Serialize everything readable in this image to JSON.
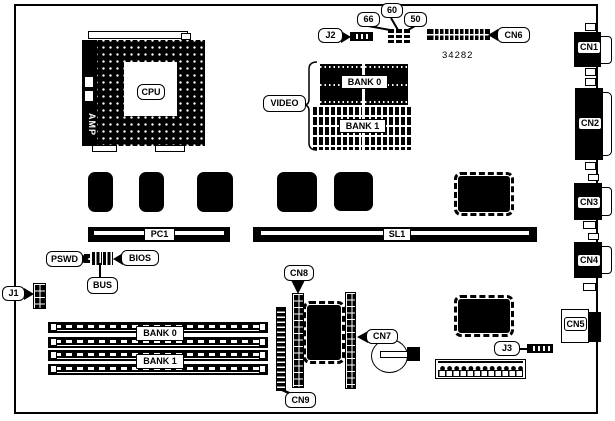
{
  "board": {
    "part_number": "34282",
    "cpu_label": "CPU",
    "cpu_socket_brand": "AMP",
    "video_label": "VIDEO",
    "video_bank0": "BANK 0",
    "video_bank1": "BANK 1",
    "simm_bank0": "BANK 0",
    "simm_bank1": "BANK 1",
    "slot_pc1": "PC1",
    "slot_sl1": "SL1",
    "jumper_j1": "J1",
    "jumper_j2": "J2",
    "jumper_j3": "J3",
    "jumper_66": "66",
    "jumper_60": "60",
    "jumper_50": "50",
    "jumper_pswd": "PSWD",
    "jumper_bios": "BIOS",
    "jumper_bus": "BUS",
    "cn1": "CN1",
    "cn2": "CN2",
    "cn3": "CN3",
    "cn4": "CN4",
    "cn5": "CN5",
    "cn6": "CN6",
    "cn7": "CN7",
    "cn8": "CN8",
    "cn9": "CN9"
  },
  "colors": {
    "ink": "#000000",
    "background": "#ffffff"
  }
}
